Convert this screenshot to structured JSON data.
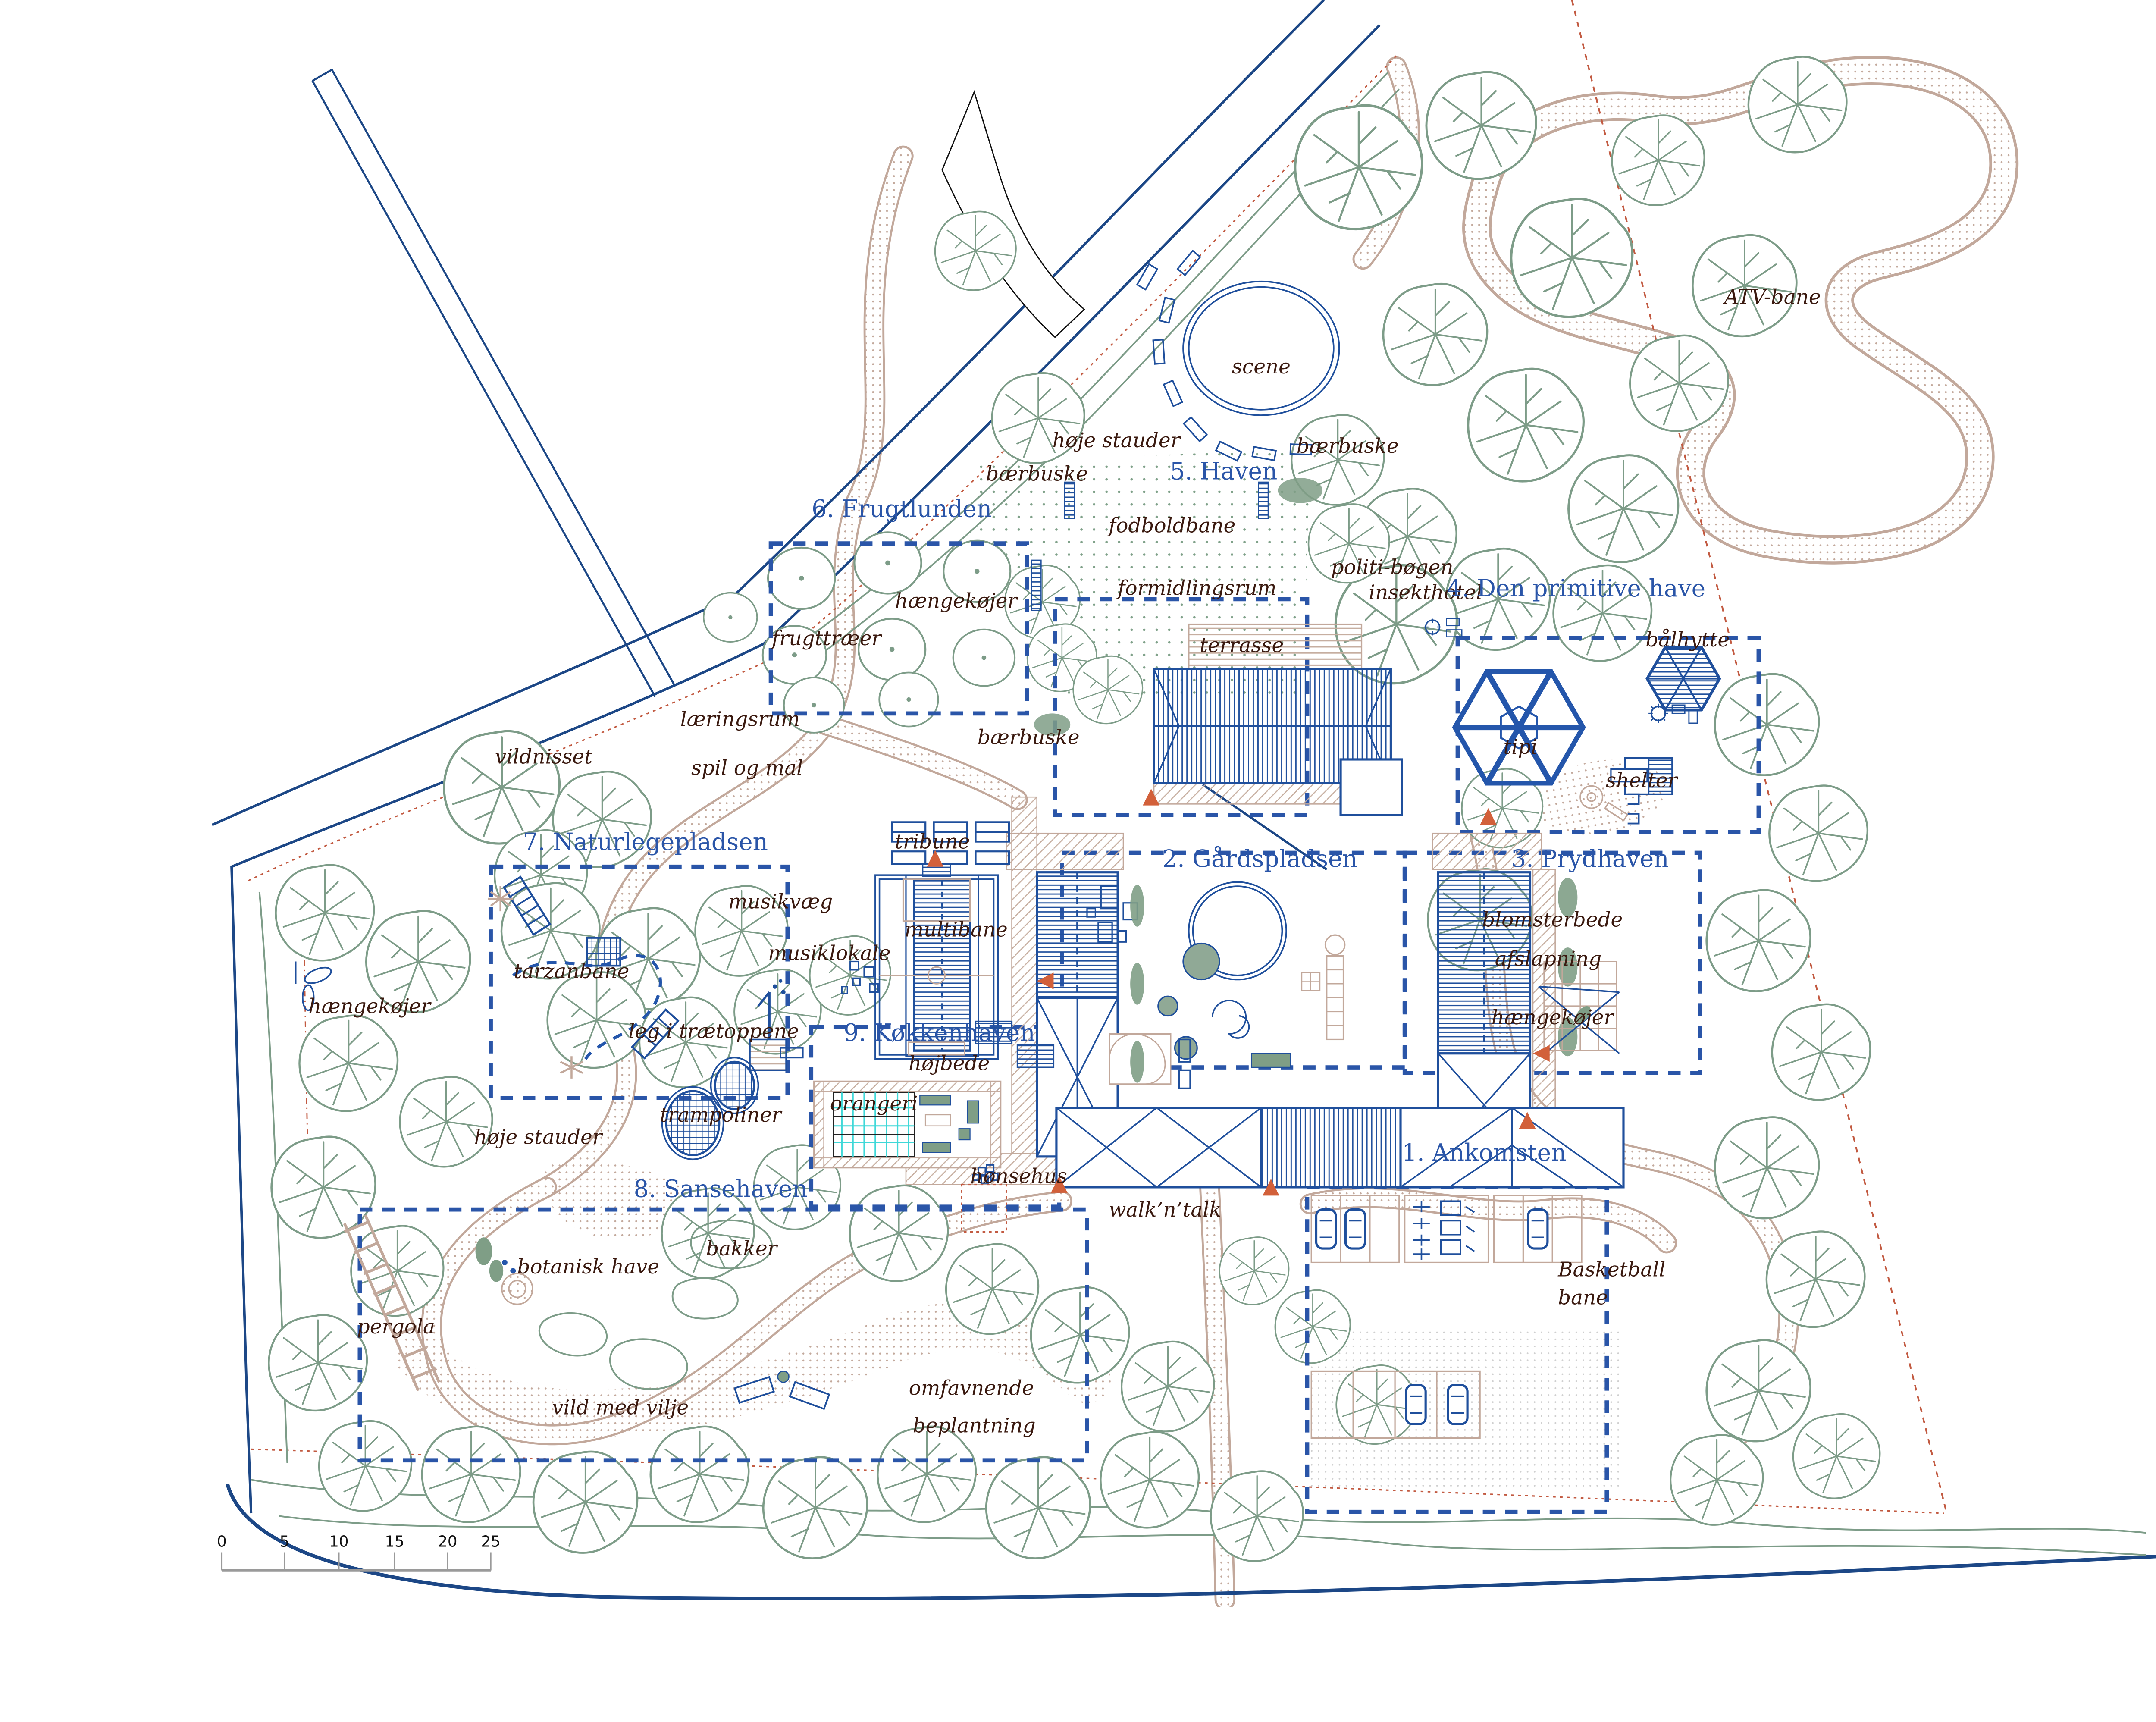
{
  "plan": {
    "areas": [
      {
        "id": 1,
        "label": "1. Ankomsten"
      },
      {
        "id": 2,
        "label": "2. Gårdspladsen"
      },
      {
        "id": 3,
        "label": "3. Prydhaven"
      },
      {
        "id": 4,
        "label": "4. Den primitive have"
      },
      {
        "id": 5,
        "label": "5. Haven"
      },
      {
        "id": 6,
        "label": "6. Frugtlunden"
      },
      {
        "id": 7,
        "label": "7. Naturlegepladsen"
      },
      {
        "id": 8,
        "label": "8. Sansehaven"
      },
      {
        "id": 9,
        "label": "9. Køkkenhaven"
      }
    ],
    "features": {
      "atv_bane": "ATV-bane",
      "scene": "scene",
      "hoje_stauder": "høje stauder",
      "baerbuske": "bærbuske",
      "fodboldbane": "fodboldbane",
      "formidlingsrum": "formidlingsrum",
      "politi_bogen": "politi-bøgen",
      "insekthotel": "insekthotel",
      "haengekojer": "hængekøjer",
      "frugttraeer": "frugttræer",
      "baalhytte": "bålhytte",
      "terrasse": "terrasse",
      "laeringsrum": "læringsrum",
      "spil_og_mal": "spil og mal",
      "vildnisset": "vildnisset",
      "tipi": "tipi",
      "shelter": "shelter",
      "tribune": "tribune",
      "musikvaeg": "musikvæg",
      "multibane": "multibane",
      "blomsterbede": "blomsterbede",
      "musiklokale": "musiklokale",
      "afslapning": "afslapning",
      "tarzanbane": "tarzanbane",
      "leg_i_traetoppene": "leg i trætoppene",
      "hojbede": "højbede",
      "trampoliner": "trampoliner",
      "orangeri": "orangeri",
      "honsehus": "hønsehus",
      "walk_n_talk": "walk’n’talk",
      "bakker": "bakker",
      "botanisk_have": "botanisk have",
      "basketball_1": "Basketball",
      "basketball_2": "bane",
      "pergola": "pergola",
      "vild_med_vilje": "vild med vilje",
      "omfavnende_1": "omfavnende",
      "omfavnende_2": "beplantning"
    },
    "scalebar": {
      "unit_values": [
        "0",
        "5",
        "10",
        "15",
        "20",
        "25"
      ]
    },
    "colors": {
      "plan_blue": "#1f4f9c",
      "area_blue": "#2a55a8",
      "road_navy": "#1c4786",
      "label_brown": "#3a190f",
      "tree_green": "#7d9c88",
      "path_tan": "#c2a89b",
      "boundary_red": "#c25a41",
      "marker_orange": "#d2603a",
      "glass_cyan": "#3fd8d8",
      "scale_gray": "#a8a8a8"
    }
  }
}
